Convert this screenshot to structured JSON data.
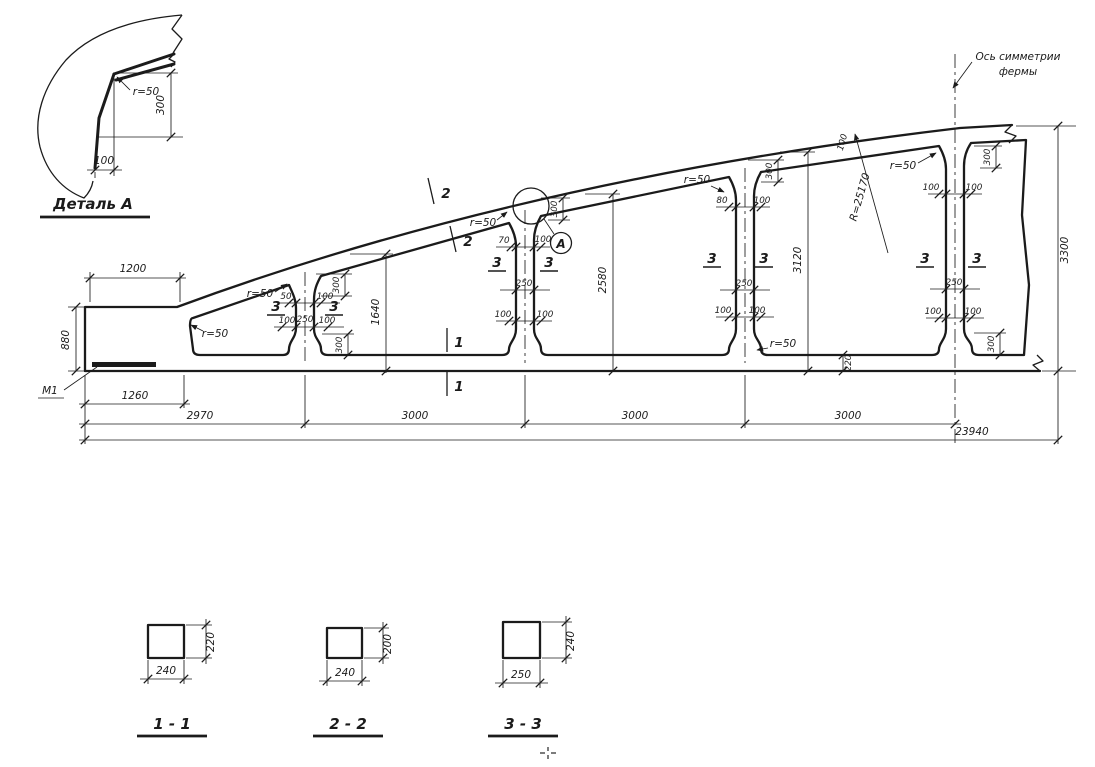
{
  "colors": {
    "ink": "#1b1b1b",
    "paper": "#ffffff"
  },
  "detail_a": {
    "title": "Деталь А"
  },
  "axis_label": {
    "line1": "Ось симметрии",
    "line2": "фермы"
  },
  "radius_label": "R=25170",
  "dims": {
    "r50": "r=50",
    "d50": "50",
    "d70": "70",
    "d80": "80",
    "d100": "100",
    "d220": "220",
    "d250": "250",
    "d300": "300",
    "d1200": "1200",
    "d880": "880",
    "d1260": "1260",
    "d2970": "2970",
    "d3000": "3000",
    "d23940": "23940",
    "h1640": "1640",
    "h2580": "2580",
    "h3120": "3120",
    "h3300": "3300"
  },
  "marks": {
    "section1": "1",
    "section2": "2",
    "section3": "3",
    "detail_ref": "А",
    "support": "М1"
  },
  "sections": [
    {
      "label": "1 - 1",
      "width": "240",
      "height": "220"
    },
    {
      "label": "2 - 2",
      "width": "240",
      "height": "200"
    },
    {
      "label": "3 - 3",
      "width": "250",
      "height": "240"
    }
  ]
}
